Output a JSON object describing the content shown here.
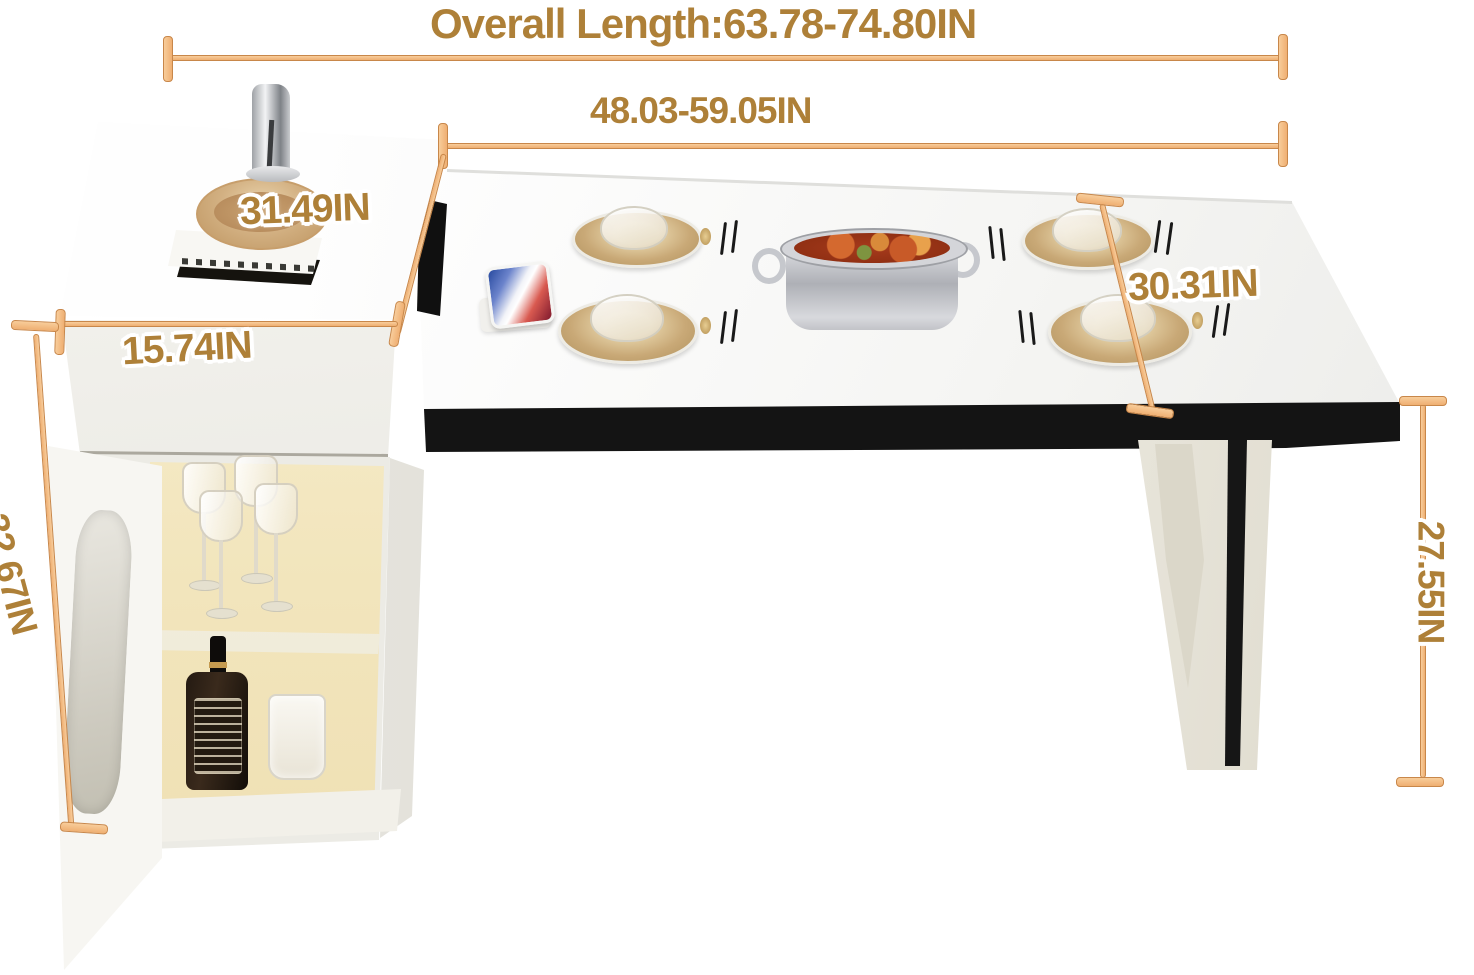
{
  "annotations": {
    "overall_length": "Overall Length:63.78-74.80IN",
    "extended_length": "48.03-59.05IN",
    "tabletop_depth": "31.49IN",
    "cabinet_depth": "15.74IN",
    "tabletop_width": "30.31IN",
    "cabinet_height": "32.67IN",
    "table_height": "27.55IN"
  },
  "colors": {
    "annotation_text": "#AE8038",
    "dimension_line": "#F2B77C",
    "dimension_line_border": "#C8874A",
    "table_apron": "#141414",
    "tabletop": "#F7F7F5",
    "cabinet_body": "#ECEBE5",
    "cabinet_interior_glow": "#F4E8C4",
    "leg_accent": "#161616",
    "hotpot_broth": "#A63A1C",
    "plate_gold": "#C3A271",
    "hardware_gold": "#C09A54"
  },
  "scene": {
    "items": [
      "faucet",
      "wooden-bowl",
      "tray-and-books",
      "wine-glasses",
      "liquor-bottle",
      "frosted-cup",
      "smartphone",
      "hot-pot",
      "place-settings"
    ]
  }
}
